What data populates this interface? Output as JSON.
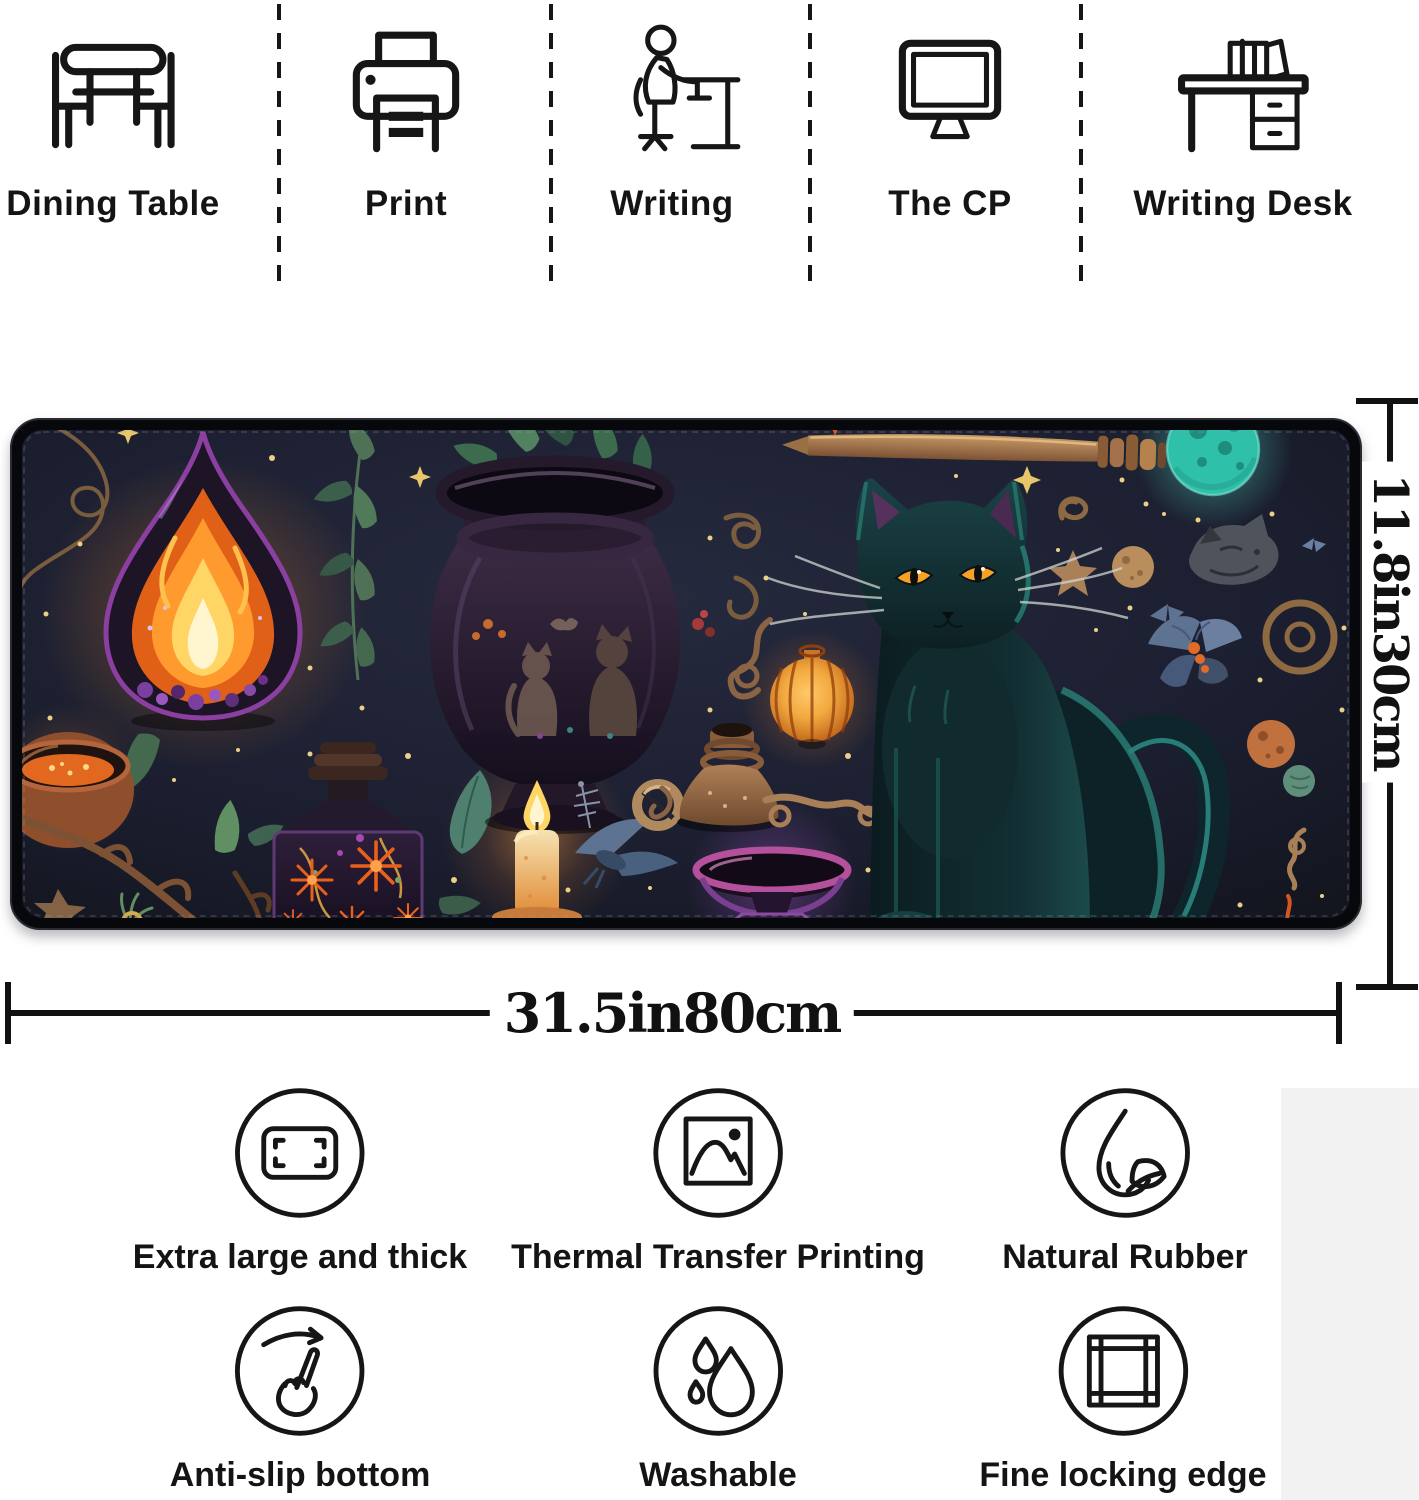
{
  "header": {
    "items": [
      {
        "label": "Dining Table",
        "icon": "dining-table-icon"
      },
      {
        "label": "Print",
        "icon": "printer-icon"
      },
      {
        "label": "Writing",
        "icon": "writing-person-icon"
      },
      {
        "label": "The CP",
        "icon": "computer-monitor-icon"
      },
      {
        "label": "Writing Desk",
        "icon": "writing-desk-icon"
      }
    ]
  },
  "pad": {
    "width_label": "31.5in80cm",
    "height_label": "11.8in30cm",
    "art": "witchy-black-cat-desk-mat-illustration",
    "colors": {
      "mat_background": "#1d2132",
      "mat_edge": "#0a0b10",
      "cat_fur": "#123034",
      "cat_eye": "#f7a225",
      "flame": "#ff9b2e",
      "moon": "#2fc0aa",
      "goblet_rim": "#b5519c",
      "lantern": "#f2a93f"
    }
  },
  "features": {
    "rows": [
      [
        {
          "label": "Extra large and thick",
          "icon": "size-frame-icon"
        },
        {
          "label": "Thermal Transfer Printing",
          "icon": "picture-icon"
        },
        {
          "label": "Natural Rubber",
          "icon": "droplet-leaf-icon"
        }
      ],
      [
        {
          "label": "Anti-slip bottom",
          "icon": "finger-swipe-icon"
        },
        {
          "label": "Washable",
          "icon": "water-drops-icon"
        },
        {
          "label": "Fine locking edge",
          "icon": "frame-edge-icon"
        }
      ]
    ]
  }
}
